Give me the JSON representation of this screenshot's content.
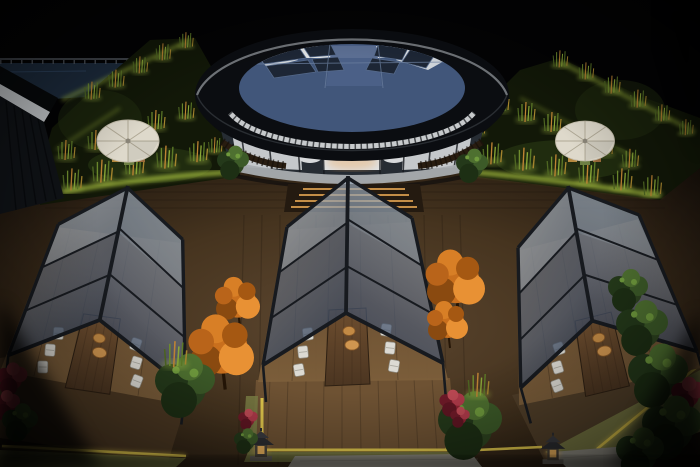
{
  "scene": {
    "description": "night aerial 3D render of a rooftop dining terrace",
    "round_glass_pavilion_count": 1,
    "a_frame_glass_dining_pavilion_count": 3,
    "patio_umbrella_count": 2,
    "stone_lantern_count": 2,
    "dining_table_count": 3,
    "chairs_per_table": 6,
    "platters_per_table": 2
  },
  "colors": {
    "sky": "#030304",
    "pool": "#1d2c3e",
    "railing": "#555b63",
    "shed_roof": "#07090b",
    "shed_fascia": "#c9cdd0",
    "shed_wall": "#101317",
    "ring": "#0b0d11",
    "ring_rim": "#82878c",
    "ring_fascia": "#c7cacc",
    "skylight_glass": "#41567a",
    "skylight_panel": "#1d2635",
    "skylight_frame": "#6d80a0",
    "roof_white": "#dfe2e3",
    "facade_glass": "#262c33",
    "wall_white": "#d7d9db",
    "art_dark": "#1b1d21",
    "sideboard": "#33373c",
    "interior_glow": "#e8a55a",
    "ledge": "#a9adb0",
    "balustrade": "#281c10",
    "terrace_dark": "#121808",
    "hedge_glow": "#a9c23f",
    "bamboo_green": "#6e8c2e",
    "bamboo_warm": "#c08434",
    "umbrella": "#ded9cb",
    "umbrella_rib": "#b0a996",
    "deck_light": "#5d4730",
    "plank_line": "#17100a",
    "led_amber": "#d69b4e",
    "frame_dark": "#171a1f",
    "glass_frost": "#c9cfd4",
    "floor_wood": "#6e5233",
    "table_light": "#7a5a38",
    "platter": "#c28a45",
    "chair": "#dcdad3",
    "grass": "#7d8046",
    "strip_yellow": "#e2c84c",
    "stone": "#9a978c",
    "tree_orange": "#c96f1d",
    "bush_green": "#2e4420",
    "plant_red": "#8e2333",
    "lantern_glow": "#e8b05c"
  }
}
